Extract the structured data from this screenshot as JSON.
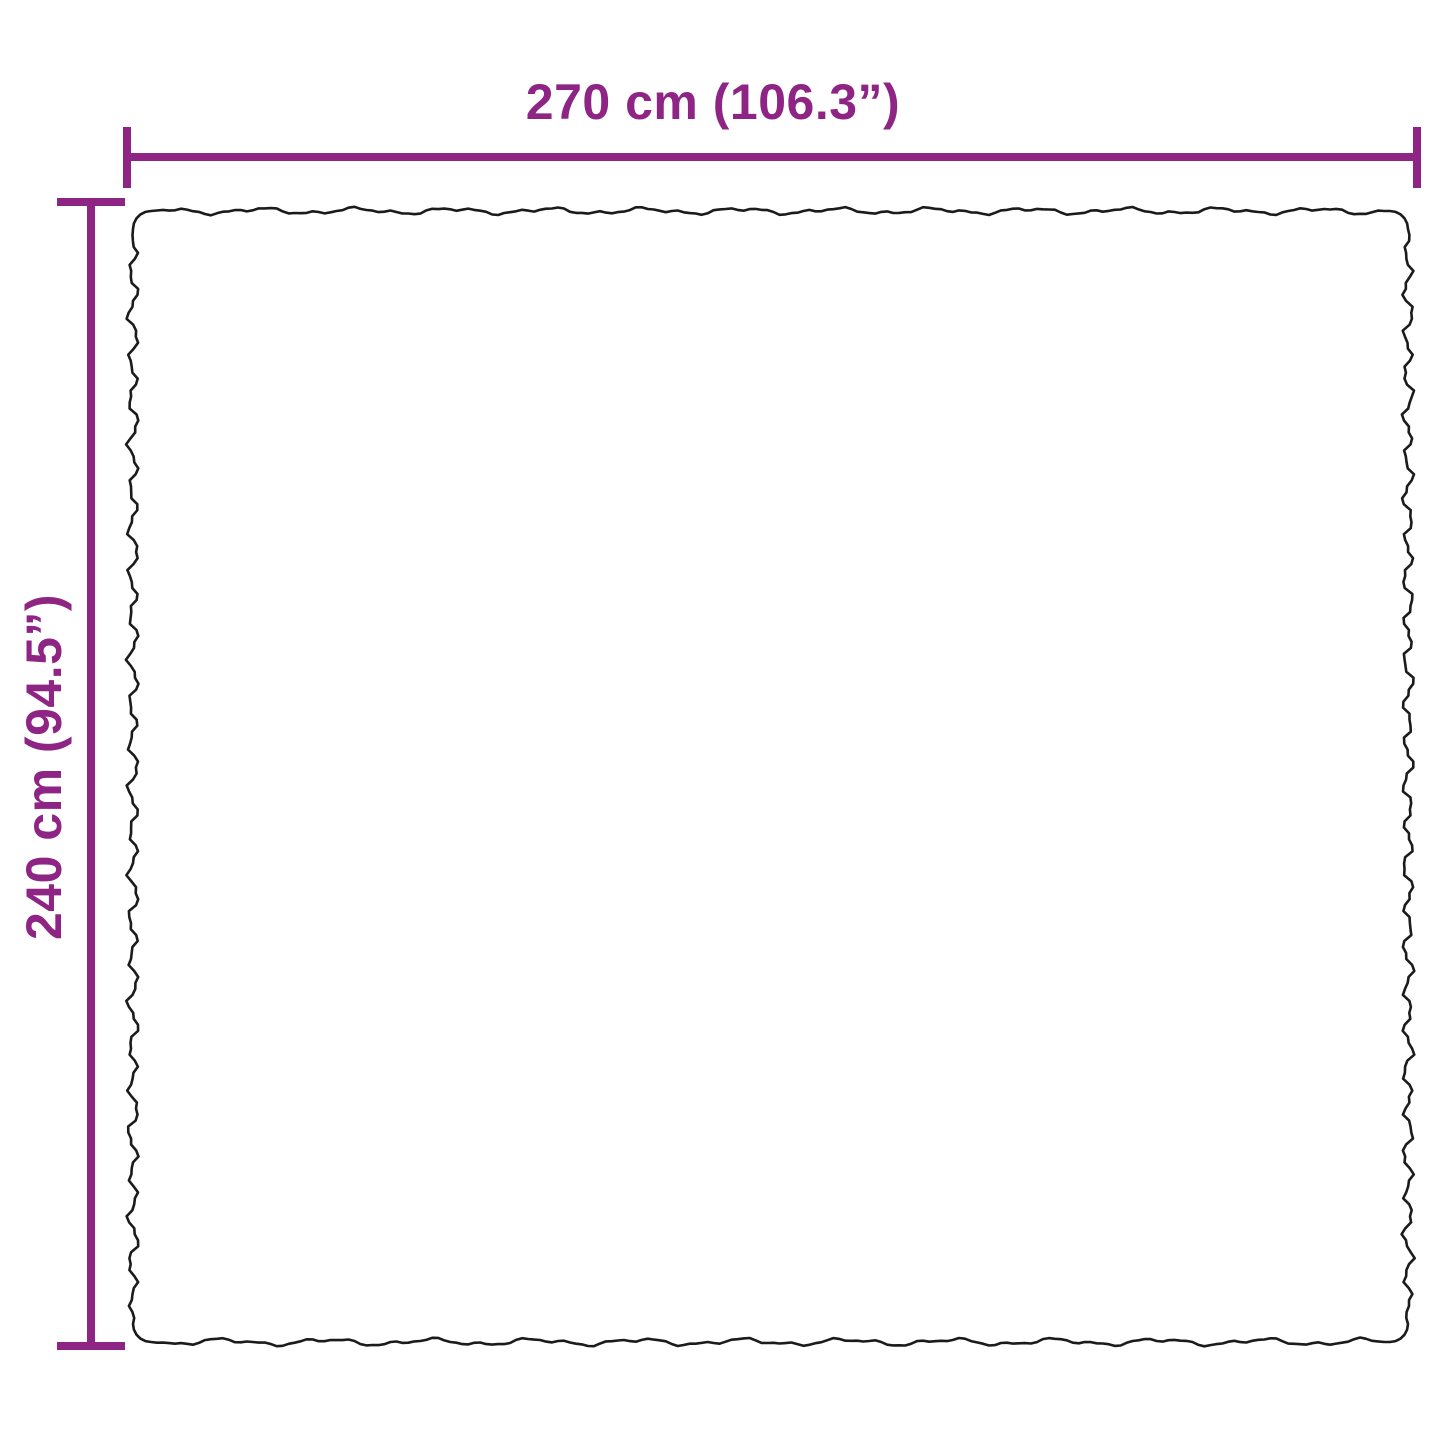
{
  "diagram": {
    "type": "product-dimension-diagram",
    "subject": "rug-with-wavy-edges",
    "width_label": "270 cm (106.3”)",
    "height_label": "240 cm (94.5”)",
    "width_cm": 270,
    "width_inches": 106.3,
    "height_cm": 240,
    "height_inches": 94.5
  },
  "colors": {
    "accent": "#8e2484",
    "outline": "#1b1b1b",
    "background": "#ffffff"
  }
}
